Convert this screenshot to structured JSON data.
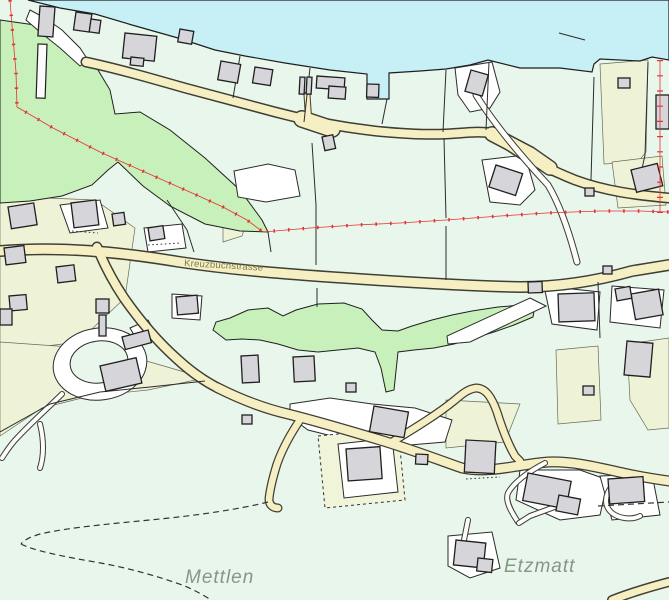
{
  "map": {
    "place_labels": [
      {
        "text": "Mettlen"
      },
      {
        "text": "Etzmatt"
      }
    ],
    "road_label": "Kreuzbuchstrasse"
  },
  "theme": {
    "background": "#e9f6eb",
    "lake": "#c6eff6",
    "forest": "#c8f0ba",
    "road_fill": "#f6efc4",
    "road_casing": "#3f3f33",
    "building_fill": "#d6d6da",
    "building_outline": "#1f1f1f",
    "parcel_line": "#2b2b2b",
    "boundary_red": "#e23333",
    "label_gray": "#889688",
    "white_area": "#ffffff",
    "tint_yellow_green": "#eef3d7"
  }
}
